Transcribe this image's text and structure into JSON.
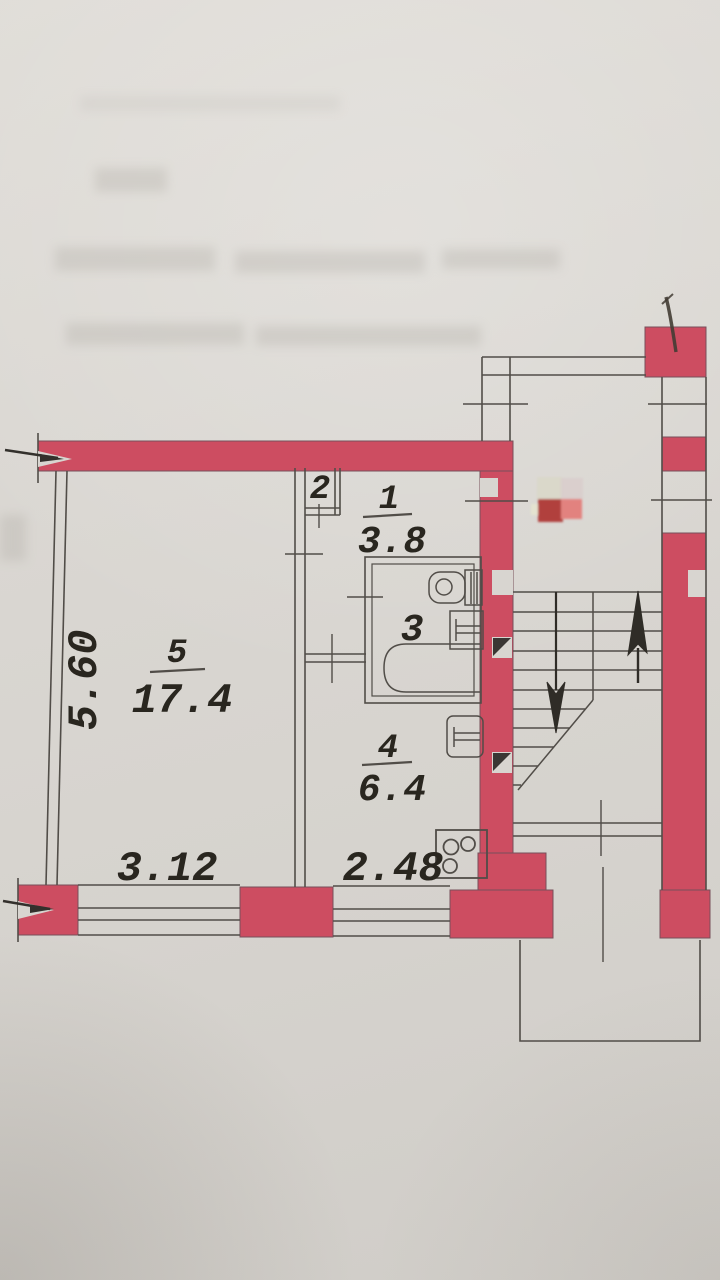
{
  "document": {
    "kind": "photographed apartment floor plan (BTI scheme)",
    "orientation": "portrait"
  },
  "rooms": [
    {
      "id": "room-5",
      "number": "5",
      "area": "17.4"
    },
    {
      "id": "room-1",
      "number": "1",
      "area": "3.8"
    },
    {
      "id": "room-2",
      "number": "2",
      "area": ""
    },
    {
      "id": "room-3",
      "number": "3",
      "area": ""
    },
    {
      "id": "room-4",
      "number": "4",
      "area": "6.4"
    }
  ],
  "dimensions": [
    {
      "id": "dim-room5-height",
      "value": "5.60",
      "orientation": "vertical"
    },
    {
      "id": "dim-room5-width",
      "value": "3.12",
      "orientation": "horizontal"
    },
    {
      "id": "dim-room4-width",
      "value": "2.48",
      "orientation": "horizontal"
    }
  ],
  "colors": {
    "paper": "#d8d5d0",
    "wall_red": "#cd4d61",
    "line": "#514d48",
    "ink": "#29261f",
    "stamp_dark_red": "#b13f3c",
    "stamp_pink": "#e2827f",
    "stamp_beige": "#d9d7c8",
    "pen_mark": "#433c34"
  }
}
